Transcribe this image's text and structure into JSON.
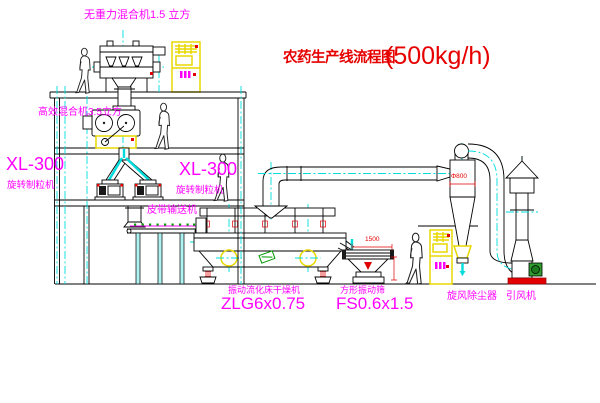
{
  "title": {
    "name_cn": "农药生产线流程图",
    "capacity": "(500kg/h)"
  },
  "equipment_labels": {
    "gravity_mixer": "无重力混合机1.5 立方",
    "high_eff_mixer": "高效混合机3.5立方",
    "granulator_left_model": "XL-300",
    "granulator_left_name": "旋转制粒机",
    "granulator_mid_model": "XL-300",
    "granulator_mid_name": "旋转制粒机",
    "belt_conveyor": "皮带输送机",
    "fluid_bed_dryer_name": "振动流化床干燥机",
    "fluid_bed_dryer_model": "ZLG6x0.75",
    "vibrating_screen_name": "方形振动筛",
    "vibrating_screen_model": "FS0.6x1.5",
    "cyclone": "旋风除尘器",
    "induced_draft_fan": "引风机"
  },
  "dimensions": {
    "screen_length": "1500",
    "cyclone_diameter": "Φ800"
  },
  "colors": {
    "line": "#000000",
    "centerline_cyan": "#00dcdc",
    "label_magenta": "#ff00ff",
    "title_red": "#e60000",
    "cabinet_yellow": "#e8d800",
    "motor_green": "#2f9e2f"
  }
}
